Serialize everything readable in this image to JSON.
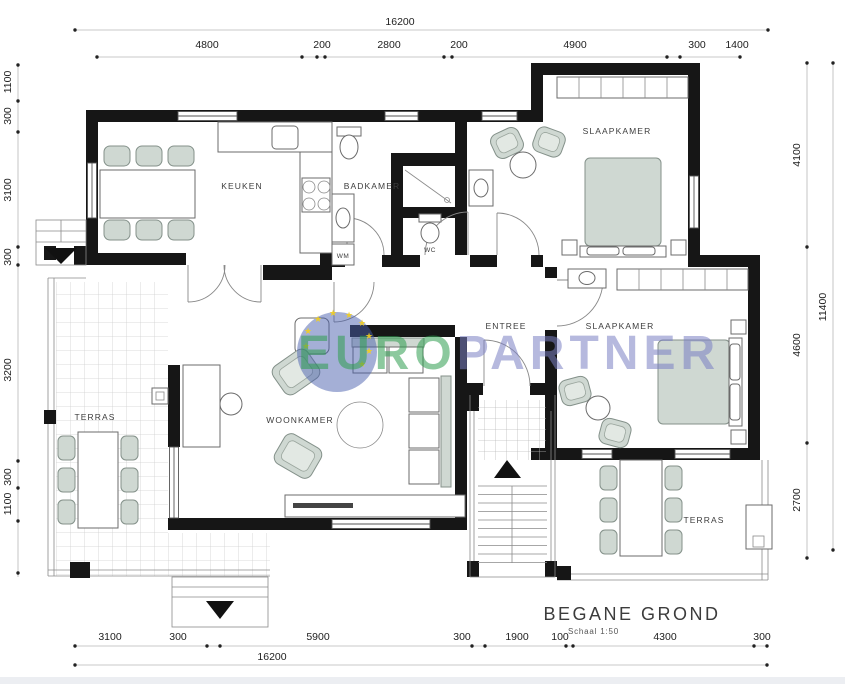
{
  "title": {
    "main": "BEGANE GROND",
    "scale": "Schaal 1:50"
  },
  "watermark": {
    "part1": "EURO",
    "part2": "PARTNER",
    "star": "★"
  },
  "rooms": [
    {
      "id": "keuken",
      "label": "KEUKEN"
    },
    {
      "id": "badkamer",
      "label": "BADKAMER"
    },
    {
      "id": "wm",
      "label": "WM"
    },
    {
      "id": "wc",
      "label": "WC"
    },
    {
      "id": "slaapkamer1",
      "label": "SLAAPKAMER"
    },
    {
      "id": "slaapkamer2",
      "label": "SLAAPKAMER"
    },
    {
      "id": "entree",
      "label": "ENTREE"
    },
    {
      "id": "woonkamer",
      "label": "WOONKAMER"
    },
    {
      "id": "terras_west",
      "label": "TERRAS"
    },
    {
      "id": "terras_zuid",
      "label": "TERRAS"
    }
  ],
  "dimensions": {
    "top_total": "16200",
    "top_segments": [
      "4800",
      "200",
      "2800",
      "200",
      "4900",
      "300",
      "1400"
    ],
    "right_segments": [
      "4100",
      "4600",
      "2700"
    ],
    "right_total": "11400",
    "left_segments": [
      "1100",
      "300",
      "3100",
      "300",
      "3200",
      "300",
      "1100"
    ],
    "bottom_segments": [
      "3100",
      "300",
      "5900",
      "300",
      "1900",
      "100",
      "4300",
      "300"
    ],
    "bottom_total": "16200"
  },
  "colors": {
    "wall": "#161616",
    "furniture_green": "#cfd8d2",
    "watermark_green": "#2f9e4f",
    "watermark_purple": "#7b80c4",
    "watermark_blue": "#4a5fae",
    "star_yellow": "#f2cf1f"
  }
}
